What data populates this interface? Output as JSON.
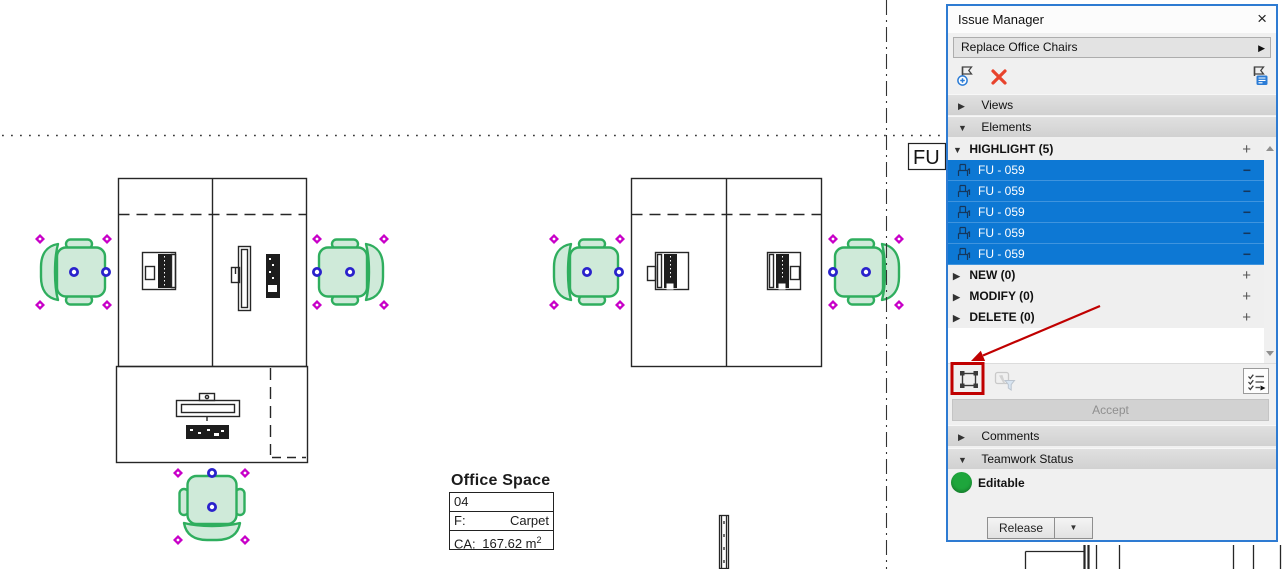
{
  "drawing": {
    "fu_label": "FU",
    "room_stamp": {
      "title": "Office Space",
      "number": "04",
      "floor_label": "F:",
      "floor_value": "Carpet",
      "area_label": "CA:",
      "area_value": "167.62 m",
      "area_exponent": "2"
    }
  },
  "panel": {
    "title": "Issue Manager",
    "issue_selector": {
      "value": "Replace Office Chairs"
    },
    "toolbar_icons": {
      "new_issue": "flag-plus-icon",
      "delete_issue": "red-x-icon",
      "issue_details": "flag-details-icon",
      "marquee": "marquee-selection-icon",
      "select_filter": "cursor-funnel-icon",
      "list_options": "checklist-arrow-icon"
    },
    "sections": {
      "views": "Views",
      "elements": "Elements",
      "comments": "Comments",
      "teamwork": "Teamwork Status"
    },
    "elements_list": {
      "highlight_label": "HIGHLIGHT (5)",
      "items": [
        {
          "label": "FU - 059"
        },
        {
          "label": "FU - 059"
        },
        {
          "label": "FU - 059"
        },
        {
          "label": "FU - 059"
        },
        {
          "label": "FU - 059"
        }
      ],
      "groups": [
        {
          "label": "NEW (0)"
        },
        {
          "label": "MODIFY (0)"
        },
        {
          "label": "DELETE (0)"
        }
      ]
    },
    "accept_label": "Accept",
    "teamwork_status": {
      "label": "Editable",
      "release_label": "Release"
    },
    "glyphs": {
      "close": "×",
      "expand_right": "▶",
      "expand_down": "▼",
      "plus": "+",
      "minus": "−",
      "dropdown_down": "▼"
    }
  },
  "colors": {
    "selection_blue": "#0d78d4",
    "panel_border": "#2e7bd2",
    "chair_fill": "#cfead9",
    "chair_stroke": "#2fae5e",
    "handle_magenta": "#c800c8",
    "handle_blue": "#2a22cc",
    "annotation_red": "#c00000",
    "editable_green": "#1ea63c"
  }
}
